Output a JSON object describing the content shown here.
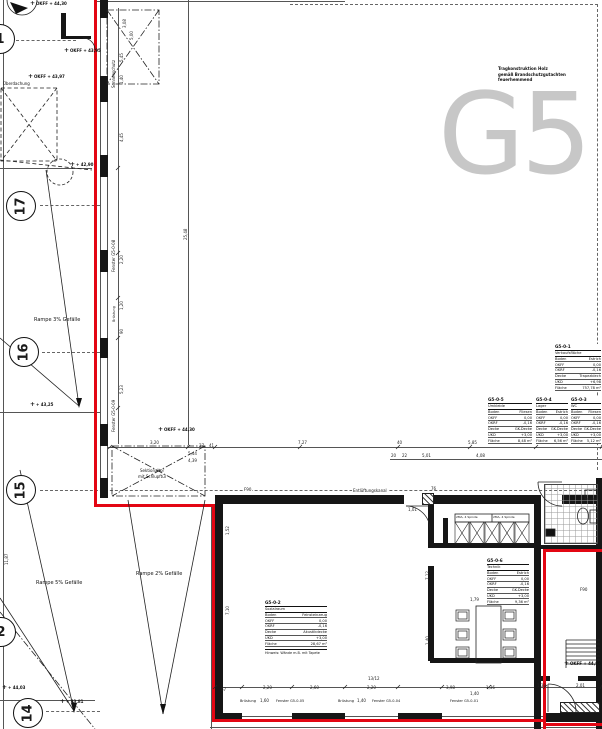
{
  "drawing": {
    "big_label": "G5",
    "construction_note": {
      "l1": "Tragkonstruktion Holz",
      "l2": "gemäß Brandschutzgutachten",
      "l3": "feuerhemmend"
    },
    "colors": {
      "fire_red": "#e30613",
      "zone_gray": "#c7c7c7"
    },
    "grid_bubbles": [
      {
        "n": "1",
        "x": 0,
        "y": 39,
        "rot": 0
      },
      {
        "n": "17",
        "x": 21,
        "y": 206,
        "rot": 1
      },
      {
        "n": "16",
        "x": 24,
        "y": 352,
        "rot": 1
      },
      {
        "n": "15",
        "x": 21,
        "y": 490,
        "rot": 1
      },
      {
        "n": "2",
        "x": 1,
        "y": 632,
        "rot": 0
      },
      {
        "n": "14",
        "x": 28,
        "y": 713,
        "rot": 1
      }
    ],
    "levels": [
      {
        "t": "OKFF + 44,30",
        "x": 30,
        "y": 1
      },
      {
        "t": "OKFF + 43,95",
        "x": 64,
        "y": 48
      },
      {
        "t": "OKFF + 43,97",
        "x": 28,
        "y": 74
      },
      {
        "t": "+ 42,90",
        "x": 70,
        "y": 162
      },
      {
        "t": "+ 43,25",
        "x": 30,
        "y": 402
      },
      {
        "t": "OKFF + 44,30",
        "x": 158,
        "y": 427
      },
      {
        "t": "OKFF + 44,80",
        "x": 564,
        "y": 661
      },
      {
        "t": "+ 43,81",
        "x": 60,
        "y": 699
      },
      {
        "t": "+ 44,03",
        "x": 2,
        "y": 685
      }
    ],
    "annotations": [
      {
        "t": "Überdachung",
        "x": 3,
        "y": 82,
        "s": 4
      },
      {
        "t": "Rampe 3% Gefälle",
        "x": 34,
        "y": 318,
        "s": 5
      },
      {
        "t": "Rampe 5% Gefälle",
        "x": 36,
        "y": 581,
        "s": 5
      },
      {
        "t": "Rampe 2% Gefälle",
        "x": 136,
        "y": 572,
        "s": 5
      },
      {
        "t": "Sektionaltor",
        "x": 140,
        "y": 469,
        "s": 4
      },
      {
        "t": "mit Schlupftür",
        "x": 138,
        "y": 475,
        "s": 4
      },
      {
        "t": "Entlüftungskanal",
        "x": 352,
        "y": 489,
        "s": 4,
        "chip": 1
      },
      {
        "t": "F90",
        "x": 243,
        "y": 488,
        "s": 4,
        "chip": 1
      },
      {
        "t": "F90",
        "x": 580,
        "y": 588,
        "s": 4
      },
      {
        "t": "Sonnenschutz",
        "x": 112,
        "y": 88,
        "s": 4,
        "r": 1
      },
      {
        "t": "Fenster G5-0-08",
        "x": 112,
        "y": 272,
        "s": 4,
        "r": 1
      },
      {
        "t": "Brüstung",
        "x": 112,
        "y": 322,
        "s": 3.5,
        "r": 1
      },
      {
        "t": "Fenster G5-0-09",
        "x": 112,
        "y": 432,
        "s": 4,
        "r": 1
      },
      {
        "t": "2MA, 4 Spinde",
        "x": 456,
        "y": 516,
        "s": 3
      },
      {
        "t": "2MA, 4 Spinde",
        "x": 493,
        "y": 516,
        "s": 3
      },
      {
        "t": "Brüstung",
        "x": 240,
        "y": 699,
        "s": 3.5
      },
      {
        "t": "Fenster G5-0-05",
        "x": 276,
        "y": 699,
        "s": 3.5
      },
      {
        "t": "Brüstung",
        "x": 338,
        "y": 699,
        "s": 3.5
      },
      {
        "t": "Fenster G5-0-04",
        "x": 372,
        "y": 699,
        "s": 3.5
      },
      {
        "t": "Fenster G5-0-01",
        "x": 450,
        "y": 699,
        "s": 3.5
      }
    ],
    "dims": [
      {
        "t": "3,08",
        "x": 123,
        "y": 28,
        "r": 1
      },
      {
        "t": "5,00",
        "x": 130,
        "y": 40,
        "r": 1
      },
      {
        "t": "5,45",
        "x": 120,
        "y": 62,
        "r": 1
      },
      {
        "t": "1,40",
        "x": 120,
        "y": 84,
        "r": 1
      },
      {
        "t": "4,45",
        "x": 120,
        "y": 142,
        "r": 1
      },
      {
        "t": "2,20",
        "x": 120,
        "y": 264,
        "r": 1
      },
      {
        "t": "1,20",
        "x": 120,
        "y": 310,
        "r": 1
      },
      {
        "t": "90",
        "x": 120,
        "y": 334,
        "r": 1
      },
      {
        "t": "5,23",
        "x": 120,
        "y": 394,
        "r": 1
      },
      {
        "t": "25,48",
        "x": 184,
        "y": 240,
        "r": 1
      },
      {
        "t": "11,87",
        "x": 5,
        "y": 565,
        "r": 1
      },
      {
        "t": "3,20",
        "x": 150,
        "y": 441
      },
      {
        "t": "5,44",
        "x": 188,
        "y": 452
      },
      {
        "t": "4,39",
        "x": 188,
        "y": 459
      },
      {
        "t": "27",
        "x": 199,
        "y": 444
      },
      {
        "t": "41",
        "x": 209,
        "y": 444
      },
      {
        "t": "7,27",
        "x": 298,
        "y": 441
      },
      {
        "t": "40",
        "x": 397,
        "y": 441
      },
      {
        "t": "5,85",
        "x": 468,
        "y": 441
      },
      {
        "t": "20",
        "x": 391,
        "y": 454
      },
      {
        "t": "22",
        "x": 402,
        "y": 454
      },
      {
        "t": "5,01",
        "x": 422,
        "y": 454
      },
      {
        "t": "4,08",
        "x": 476,
        "y": 454
      },
      {
        "t": "76",
        "x": 431,
        "y": 487
      },
      {
        "t": "1,01",
        "x": 408,
        "y": 508
      },
      {
        "t": "1,52",
        "x": 226,
        "y": 535,
        "r": 1
      },
      {
        "t": "7,10",
        "x": 226,
        "y": 615,
        "r": 1
      },
      {
        "t": "7,12",
        "x": 426,
        "y": 580,
        "r": 1
      },
      {
        "t": "1,40",
        "x": 426,
        "y": 645,
        "r": 1
      },
      {
        "t": "1,79",
        "x": 470,
        "y": 598
      },
      {
        "t": "67",
        "x": 221,
        "y": 688
      },
      {
        "t": "2,20",
        "x": 263,
        "y": 686
      },
      {
        "t": "2,60",
        "x": 310,
        "y": 686
      },
      {
        "t": "2,20",
        "x": 367,
        "y": 686
      },
      {
        "t": "3,98",
        "x": 446,
        "y": 686
      },
      {
        "t": "1,36",
        "x": 486,
        "y": 686
      },
      {
        "t": "1,38",
        "x": 537,
        "y": 684
      },
      {
        "t": "2,01",
        "x": 576,
        "y": 684
      },
      {
        "t": "1,40",
        "x": 470,
        "y": 692
      },
      {
        "t": "13/12",
        "x": 368,
        "y": 677
      },
      {
        "t": "1,60",
        "x": 260,
        "y": 699
      },
      {
        "t": "1,40",
        "x": 357,
        "y": 699
      }
    ],
    "tables": [
      {
        "id": "G5-0-1",
        "name": "Verkaufsfläche",
        "x": 555,
        "y": 344,
        "w": 46,
        "rows": [
          [
            "Boden",
            "Estrich"
          ],
          [
            "OKFF",
            "0,00"
          ],
          [
            "OKRF",
            "-0,16"
          ],
          [
            "Decke",
            "Trapezblech"
          ],
          [
            "UKD",
            "+6,98"
          ],
          [
            "Fläche",
            "757,78 m²"
          ]
        ]
      },
      {
        "id": "G5-0-5",
        "name": "Umkleide",
        "x": 488,
        "y": 397,
        "w": 44,
        "rows": [
          [
            "Boden",
            "Fliesen"
          ],
          [
            "OKFF",
            "0,00"
          ],
          [
            "OKRF",
            "-0,16"
          ],
          [
            "Decke",
            "GK-Decke"
          ],
          [
            "UKD",
            "+3,00"
          ],
          [
            "Fläche",
            "8,48 m²"
          ]
        ]
      },
      {
        "id": "G5-0-4",
        "name": "Lager",
        "x": 536,
        "y": 397,
        "w": 32,
        "rows": [
          [
            "Boden",
            "Estrich"
          ],
          [
            "OKFF",
            "0,00"
          ],
          [
            "OKRF",
            "-0,16"
          ],
          [
            "Decke",
            "GK-Decke"
          ],
          [
            "UKD",
            "+3,00"
          ],
          [
            "Fläche",
            "6,56 m²"
          ]
        ]
      },
      {
        "id": "G5-0-3",
        "name": "WC",
        "x": 571,
        "y": 397,
        "w": 30,
        "rows": [
          [
            "Boden",
            "Fliesen"
          ],
          [
            "OKFF",
            "0,00"
          ],
          [
            "OKRF",
            "-0,16"
          ],
          [
            "Decke",
            "GK-Decke"
          ],
          [
            "UKD",
            "+3,00"
          ],
          [
            "Fläche",
            "5,12 m²"
          ]
        ]
      },
      {
        "id": "G5-0-6",
        "name": "Technik",
        "x": 487,
        "y": 558,
        "w": 42,
        "rows": [
          [
            "Boden",
            "Estrich"
          ],
          [
            "OKFF",
            "0,00"
          ],
          [
            "OKRF",
            "-0,16"
          ],
          [
            "Decke",
            "GK-Decke"
          ],
          [
            "UKD",
            "+3,00"
          ],
          [
            "Fläche",
            "9,36 m²"
          ]
        ]
      },
      {
        "id": "G5-0-2",
        "name": "Sozialraum",
        "x": 265,
        "y": 600,
        "w": 62,
        "rows": [
          [
            "Boden",
            "Feinsteinzeug"
          ],
          [
            "OKFF",
            "0,00"
          ],
          [
            "OKRF",
            "-0,16"
          ],
          [
            "Decke",
            "Akustikdecke"
          ],
          [
            "UKD",
            "+3,00"
          ],
          [
            "Fläche",
            "28,67 m²"
          ]
        ],
        "note": "Hinweis: Wände m.B. mit Tapete"
      }
    ]
  }
}
